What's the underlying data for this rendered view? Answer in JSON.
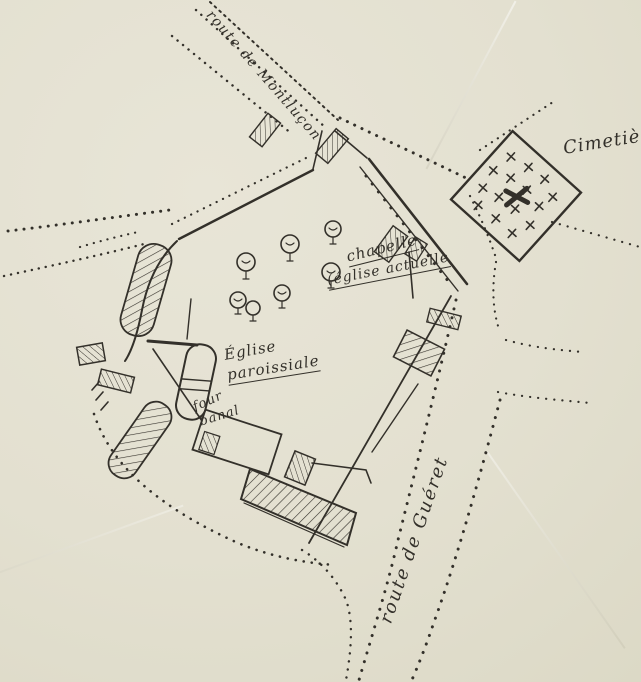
{
  "map": {
    "paper_color": "#e3e0d0",
    "ink_color": "#33302a",
    "labels": {
      "cimetiere": "Cimetière",
      "chapelle_line1": "chapelle",
      "chapelle_line2": "(église actuelle",
      "eglise_line1": "Église",
      "eglise_line2": "paroissiale",
      "four_line1": "four",
      "four_line2": "banal",
      "route_gueret": "route de Guéret",
      "route_nord": "route de Montluçon"
    },
    "symbols": {
      "cemetery_cross": "+",
      "tree": "circle-with-trunk",
      "building": "hatched-rectangle",
      "road": "dotted-double-line"
    }
  }
}
